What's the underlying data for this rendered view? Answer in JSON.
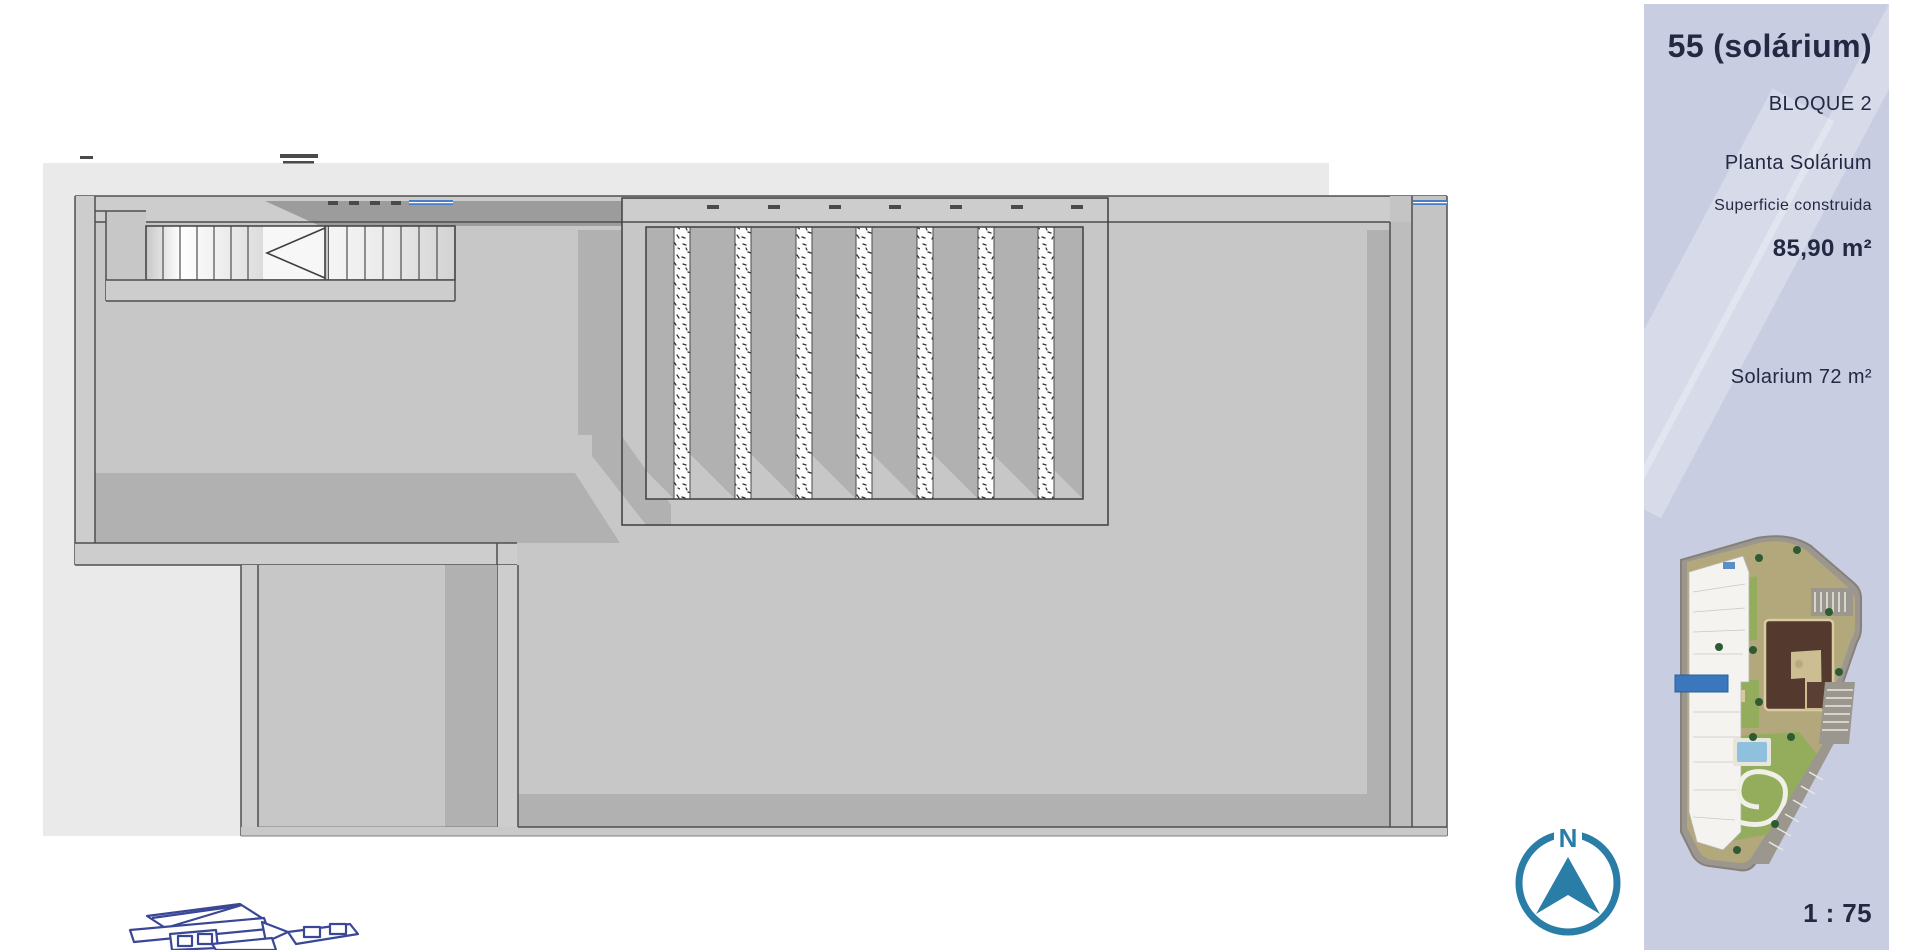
{
  "sidebar": {
    "title": "55 (solárium)",
    "block": "BLOQUE 2",
    "floor_name": "Planta Solárium",
    "area_label": "Superficie construida",
    "area_value": "85,90 m²",
    "solarium_area": "Solarium 72 m²",
    "scale": "1 : 75"
  },
  "compass": {
    "letter": "N"
  },
  "colors": {
    "backdrop": "#eaeaea",
    "floor": "#c7c7c7",
    "wall_fill": "#cdcdcd",
    "wall_line": "#4f4f4f",
    "shadow": "#b1b1b1",
    "band_dark": "#9c9c9c",
    "glass_blue": "#4a7fc1",
    "sidebar_bg": "#c8cde1",
    "sidebar_text": "#232942",
    "compass_teal": "#2a7da6",
    "blueprint_navy": "#3a4796",
    "site_highlight": "#3a77bd"
  }
}
